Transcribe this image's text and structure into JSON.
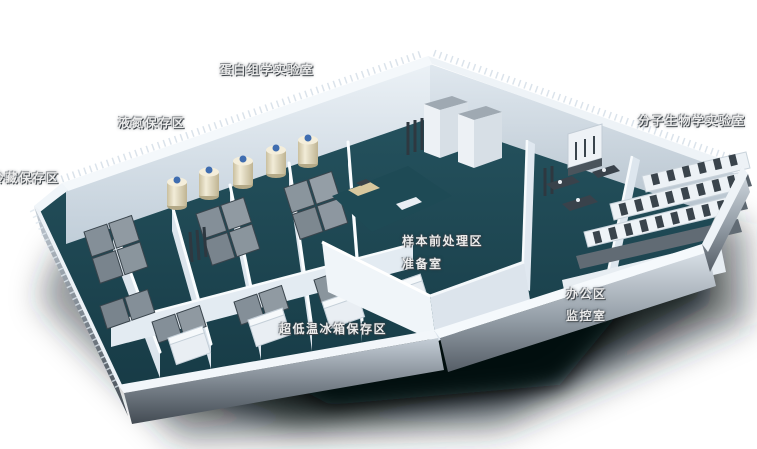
{
  "floorplan": {
    "labels": {
      "proteomics_lab": "蛋白组学实验室",
      "liquid_nitrogen_area": "液氮保存区",
      "cold_storage_area": "冷藏保存区",
      "molecular_biology_lab": "分子生物学实验室",
      "sample_pretreatment_area": "样本前处理区",
      "prep_room": "准备室",
      "office_area": "办公区",
      "monitoring_room": "监控室",
      "ult_freezer_area": "超低温冰箱保存区"
    },
    "colors": {
      "background": "#ffffff",
      "floor_teal": "#1d4a55",
      "wall_white": "#eef3f7",
      "shadow_dark": "#0f1418",
      "freezer_gray": "#828d96",
      "dewar_cream": "#e9e1c9",
      "dewar_cap_blue": "#3f6db0",
      "bench_gray": "#5d676f",
      "label_text": "#ececec"
    }
  }
}
